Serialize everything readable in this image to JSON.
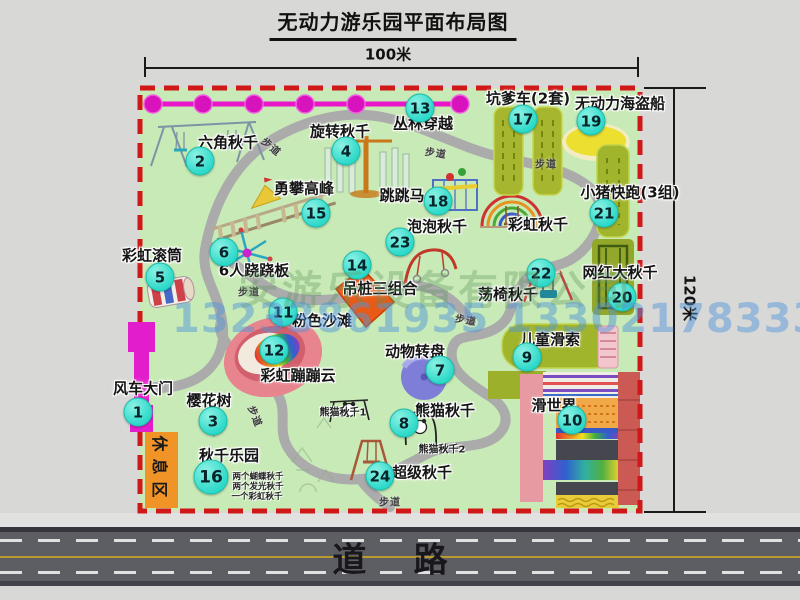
{
  "title": "无动力游乐园平面布局图",
  "dimensions": {
    "top": "100米",
    "right": "120米"
  },
  "road_label": "道    路",
  "rest_area_label": "休息区",
  "walkway_label": "步道",
  "watermarks": {
    "company": "安游乐设备有限公司",
    "phone": "13233861935 13302178333"
  },
  "colors": {
    "badge": "#2dd9c9",
    "border_red": "#d01818",
    "park_green": "#c8eab6",
    "path_gray": "#ababab",
    "road_gray": "#5d5d64",
    "gate_magenta": "#e21ecc",
    "facility_olive": "#a0b42c",
    "rest_orange": "#f09428"
  },
  "walkways": [
    {
      "x": 272,
      "y": 146,
      "rot": 40
    },
    {
      "x": 436,
      "y": 152,
      "rot": 8
    },
    {
      "x": 546,
      "y": 163,
      "rot": 0
    },
    {
      "x": 249,
      "y": 291,
      "rot": 0
    },
    {
      "x": 466,
      "y": 319,
      "rot": 10
    },
    {
      "x": 256,
      "y": 416,
      "rot": 68
    },
    {
      "x": 390,
      "y": 501,
      "rot": 0
    }
  ],
  "facilities": [
    {
      "num": "1",
      "label": "风车大门",
      "badge": {
        "x": 138,
        "y": 412
      },
      "text": {
        "x": 143,
        "y": 388
      }
    },
    {
      "num": "2",
      "label": "六角秋千",
      "badge": {
        "x": 200,
        "y": 161
      },
      "text": {
        "x": 228,
        "y": 142
      }
    },
    {
      "num": "3",
      "label": "樱花树",
      "badge": {
        "x": 213,
        "y": 421
      },
      "text": {
        "x": 209,
        "y": 400
      }
    },
    {
      "num": "4",
      "label": "旋转秋千",
      "badge": {
        "x": 346,
        "y": 151
      },
      "text": {
        "x": 340,
        "y": 131
      }
    },
    {
      "num": "5",
      "label": "彩虹滚筒",
      "badge": {
        "x": 160,
        "y": 277
      },
      "text": {
        "x": 152,
        "y": 255
      }
    },
    {
      "num": "6",
      "label": "6人跷跷板",
      "badge": {
        "x": 224,
        "y": 252
      },
      "text": {
        "x": 254,
        "y": 270
      }
    },
    {
      "num": "7",
      "label": "动物转盘",
      "badge": {
        "x": 440,
        "y": 370
      },
      "text": {
        "x": 415,
        "y": 351
      }
    },
    {
      "num": "8",
      "label": "熊猫秋千",
      "badge": {
        "x": 404,
        "y": 423
      },
      "text": {
        "x": 445,
        "y": 410
      },
      "subs": [
        {
          "t": "熊猫秋千1",
          "x": 343,
          "y": 411,
          "fs": 10
        },
        {
          "t": "熊猫秋千2",
          "x": 442,
          "y": 448,
          "fs": 10
        }
      ]
    },
    {
      "num": "9",
      "label": "儿童滑索",
      "badge": {
        "x": 527,
        "y": 357
      },
      "text": {
        "x": 550,
        "y": 339
      }
    },
    {
      "num": "10",
      "label": "滑世界",
      "badge": {
        "x": 572,
        "y": 420
      },
      "text": {
        "x": 554,
        "y": 405
      }
    },
    {
      "num": "11",
      "label": "粉色沙滩",
      "badge": {
        "x": 283,
        "y": 312
      },
      "text": {
        "x": 322,
        "y": 320
      }
    },
    {
      "num": "12",
      "label": "彩虹蹦蹦云",
      "badge": {
        "x": 274,
        "y": 350
      },
      "text": {
        "x": 298,
        "y": 375
      }
    },
    {
      "num": "13",
      "label": "丛林穿越",
      "badge": {
        "x": 420,
        "y": 108
      },
      "text": {
        "x": 423,
        "y": 123
      }
    },
    {
      "num": "14",
      "label": "吊桩三组合",
      "badge": {
        "x": 357,
        "y": 265
      },
      "text": {
        "x": 380,
        "y": 288
      }
    },
    {
      "num": "15",
      "label": "勇攀高峰",
      "badge": {
        "x": 316,
        "y": 213
      },
      "text": {
        "x": 304,
        "y": 188
      }
    },
    {
      "num": "16",
      "label": "秋千乐园",
      "badge": {
        "x": 211,
        "y": 477,
        "d": 33
      },
      "text": {
        "x": 229,
        "y": 455
      },
      "subs": [
        {
          "t": "两个蝴蝶秋千",
          "x": 258,
          "y": 476,
          "fs": 8.5
        },
        {
          "t": "两个发光秋千",
          "x": 258,
          "y": 486,
          "fs": 8.5
        },
        {
          "t": "一个彩虹秋千",
          "x": 257,
          "y": 496,
          "fs": 8.5
        }
      ]
    },
    {
      "num": "17",
      "label": "坑爹车(2套)",
      "badge": {
        "x": 523,
        "y": 119
      },
      "text": {
        "x": 528,
        "y": 98
      }
    },
    {
      "num": "18",
      "label": "跳跳马",
      "badge": {
        "x": 438,
        "y": 201
      },
      "text": {
        "x": 402,
        "y": 195
      }
    },
    {
      "num": "19",
      "label": "无动力海盗船",
      "badge": {
        "x": 591,
        "y": 121
      },
      "text": {
        "x": 620,
        "y": 103
      }
    },
    {
      "num": "20",
      "label": "网红大秋千",
      "badge": {
        "x": 622,
        "y": 297
      },
      "text": {
        "x": 620,
        "y": 272
      }
    },
    {
      "num": "21",
      "label": "小猪快跑(3组)",
      "badge": {
        "x": 604,
        "y": 213
      },
      "text": {
        "x": 630,
        "y": 192
      }
    },
    {
      "num": "22",
      "label": "荡椅秋千",
      "badge": {
        "x": 541,
        "y": 273
      },
      "text": {
        "x": 508,
        "y": 294
      }
    },
    {
      "num": "23",
      "label": "泡泡秋千",
      "badge": {
        "x": 400,
        "y": 242
      },
      "text": {
        "x": 437,
        "y": 226
      }
    },
    {
      "num": "24",
      "label": "超级秋千",
      "badge": {
        "x": 380,
        "y": 476
      },
      "text": {
        "x": 422,
        "y": 472
      }
    },
    {
      "num": "",
      "label": "彩虹秋千",
      "text": {
        "x": 538,
        "y": 224
      }
    }
  ]
}
